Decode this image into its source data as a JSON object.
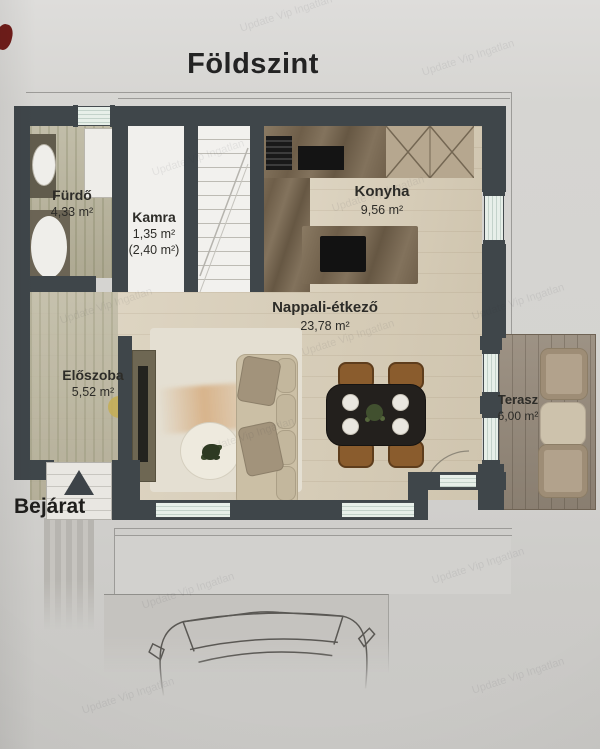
{
  "title": "Földszint",
  "watermark": "Update Vip Ingatlan",
  "entrance": {
    "label": "Bejárat",
    "arrow_icon": "triangle-up"
  },
  "rooms": {
    "furdo": {
      "name": "Fürdő",
      "area": "4,33 m²"
    },
    "kamra": {
      "name": "Kamra",
      "area": "1,35 m²",
      "area_alt": "(2,40 m²)"
    },
    "konyha": {
      "name": "Konyha",
      "area": "9,56 m²"
    },
    "nappali": {
      "name": "Nappali-étkező",
      "area": "23,78 m²"
    },
    "eloszoba": {
      "name": "Előszoba",
      "area": "5,52 m²"
    },
    "terasz": {
      "name": "Terasz",
      "area": "6,00 m²"
    }
  },
  "furniture_visible": {
    "bathroom": [
      "sink-counter",
      "washing-machine",
      "bathtub"
    ],
    "kitchen": [
      "counter",
      "vent-grill",
      "cooktop",
      "upper-cabinets",
      "island",
      "black-sink"
    ],
    "living": [
      "tv-console",
      "rug",
      "coffee-table",
      "plant",
      "sofa",
      "dining-table",
      "4-chairs",
      "door-swing-arc"
    ],
    "terrace": [
      "lounge-chair",
      "side-table",
      "lounge-chair"
    ],
    "outside": [
      "driveway",
      "parking-pad",
      "car-outline"
    ]
  },
  "colors": {
    "wall": "#3f464a",
    "floor_wood": "#d8cdb6",
    "floor_bath": "#b7b29a",
    "terrace_deck": "#95897a",
    "window_glass": "#e3ece7",
    "counter_marble": "#7b6b56",
    "rug_accent_orange": "#c97f35",
    "background": "#d6d5d2",
    "text": "#2b2a27",
    "corner_mark_red": "#701d1a"
  }
}
